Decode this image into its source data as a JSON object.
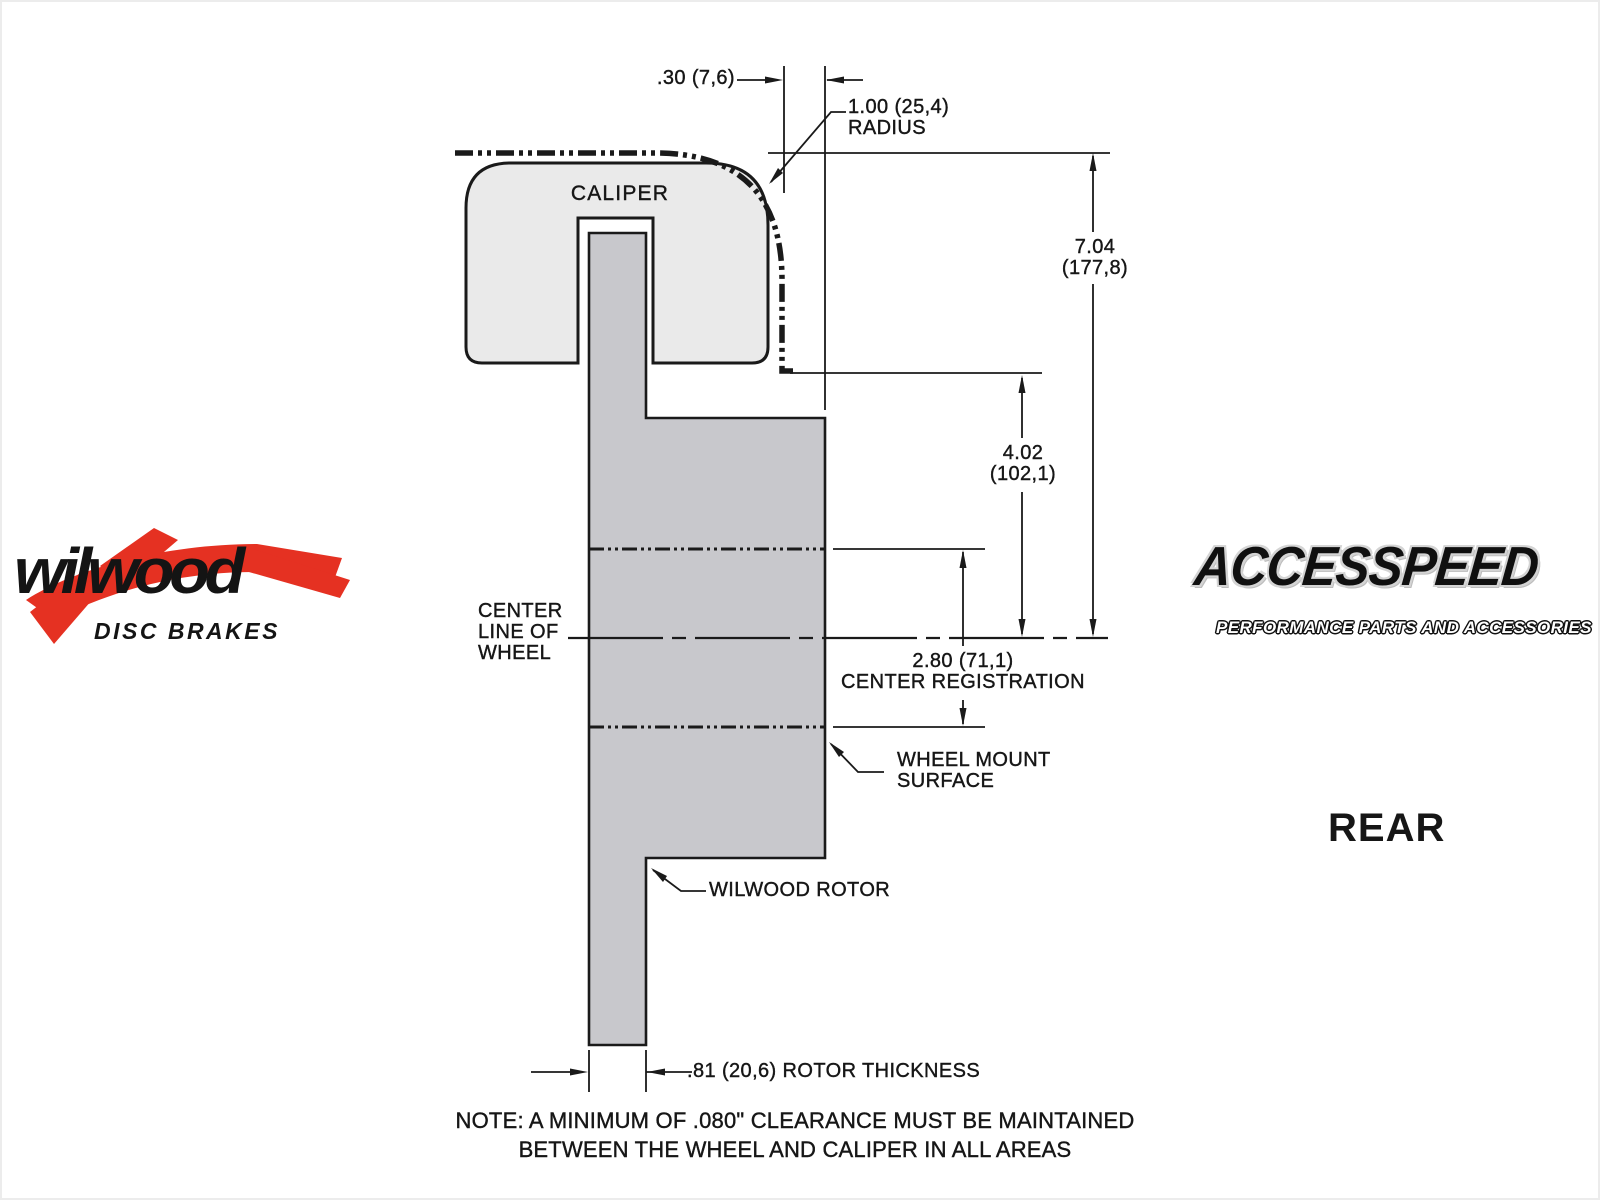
{
  "colors": {
    "caliper_fill": "#eaeaea",
    "rotor_fill": "#c8c8cc",
    "line": "#1a1a1a",
    "wilwood_red": "#e53122"
  },
  "diagram": {
    "labels": {
      "caliper": "CALIPER",
      "centerline": [
        "CENTER",
        "LINE OF",
        "WHEEL"
      ],
      "wheel_mount": [
        "WHEEL MOUNT",
        "SURFACE"
      ],
      "rotor": "WILWOOD ROTOR"
    },
    "dims": {
      "offset": ".30 (7,6)",
      "radius": [
        "1.00 (25,4)",
        "RADIUS"
      ],
      "overall": [
        "7.04",
        "(177,8)"
      ],
      "center_height": [
        "4.02",
        "(102,1)"
      ],
      "registration": [
        "2.80 (71,1)",
        "CENTER REGISTRATION"
      ],
      "thickness": ".81 (20,6) ROTOR THICKNESS"
    },
    "note": [
      "NOTE: A MINIMUM OF .080\" CLEARANCE MUST BE MAINTAINED",
      "BETWEEN THE WHEEL AND CALIPER IN ALL AREAS"
    ],
    "view": "REAR"
  },
  "branding": {
    "wilwood": {
      "name": "wilwood",
      "tagline": "DISC BRAKES"
    },
    "accesspeed": {
      "name": "ACCESSPEED",
      "tagline": "PERFORMANCE PARTS AND ACCESSORIES"
    }
  }
}
